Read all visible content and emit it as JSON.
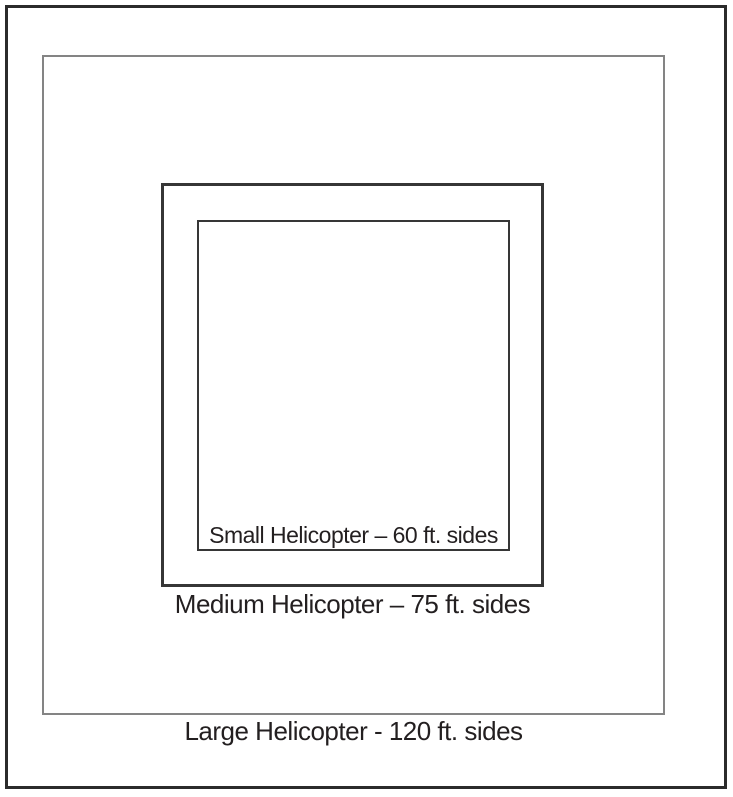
{
  "diagram": {
    "background_color": "#ffffff",
    "text_color": "#231f20",
    "outer_frame": {
      "border_color": "#2b2b2b"
    },
    "squares": {
      "large": {
        "label": "Large Helicopter - 120 ft. sides",
        "side_ft": 120,
        "border_color": "#848484"
      },
      "medium": {
        "label": "Medium Helicopter – 75 ft. sides",
        "side_ft": 75,
        "border_color": "#363636"
      },
      "small": {
        "label": "Small Helicopter – 60 ft. sides",
        "side_ft": 60,
        "border_color": "#363636"
      }
    }
  }
}
